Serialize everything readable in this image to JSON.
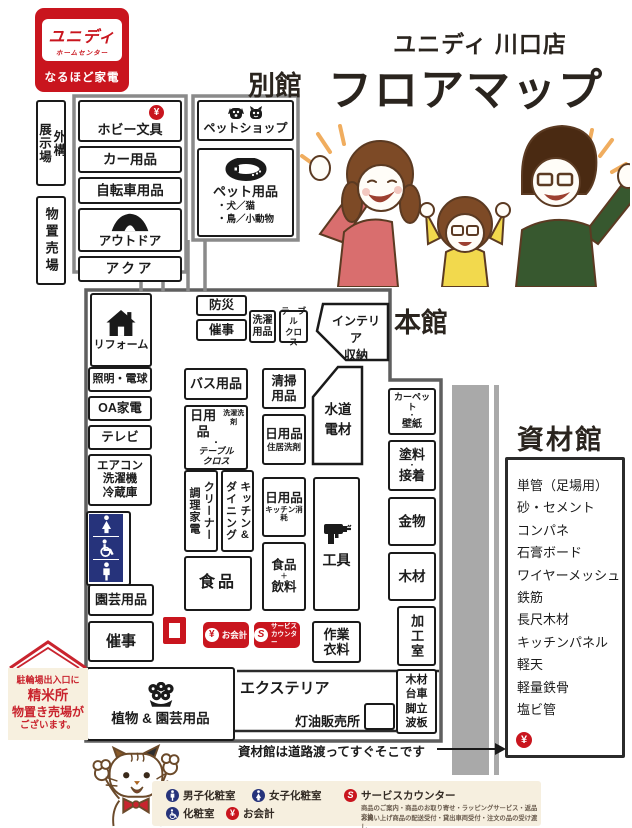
{
  "logo": {
    "brand": "ユニディ",
    "brand_sub": "ホームセンター",
    "tagline": "なるほど家電"
  },
  "title": {
    "store": "ユニディ 川口店",
    "heading": "フロアマップ"
  },
  "sections": {
    "annex": "別館",
    "main": "本館",
    "materials": "資材館"
  },
  "annex": {
    "outdoor_display": "外構\n展示場",
    "storage": "物置売場",
    "hobby": "ホビー文具",
    "car": "カー用品",
    "bicycle": "自転車用品",
    "outdoor": "アウトドア",
    "aqua": "アクア",
    "pet_shop": "ペットショップ",
    "pet_goods": "ペット用品",
    "pet_note": "・犬／猫\n・鳥／小動物"
  },
  "main": {
    "bousai": "防災",
    "event_upper": "催事",
    "laundry": "洗濯\n用品",
    "tablecloth": "テーブル\nクロス",
    "interior_storage": "インテリア\n収納",
    "reform": "リフォーム",
    "lighting": "照明・電球",
    "oa": "OA家電",
    "tv": "テレビ",
    "aircon": "エアコン\n洗濯機\n冷蔵庫",
    "garden": "園芸用品",
    "event_lower": "催事",
    "bath": "バス用品",
    "daily_laundry": {
      "main": "日用品",
      "sub": "洗濯洗剤",
      "dot": "・",
      "sub2": "テーブル\nクロス"
    },
    "cleaning": "清掃\n用品",
    "daily_house": {
      "main": "日用品",
      "sub": "住居洗剤"
    },
    "water": "水道\n電材",
    "cleaner": "クリーナー\n調理家電",
    "kitchen_dining": "キッチン&\nダイニング",
    "food": "食品",
    "daily_kitchen": {
      "main": "日用品",
      "sub": "キッチン消耗"
    },
    "food_drink": {
      "a": "食品",
      "plus": "＋",
      "b": "飲料"
    },
    "tools": "工具",
    "carpet": {
      "a": "カーペット",
      "dot": "・",
      "b": "壁紙"
    },
    "paint": {
      "a": "塗料",
      "dot": "・",
      "b": "接着"
    },
    "hardware": "金物",
    "wood": "木材",
    "workshop": "加工室",
    "workwear": "作業\n衣料",
    "exterior": "エクステリア",
    "kerosene": "灯油販売所",
    "lumber_cart": "木材\n台車\n脚立\n波板",
    "plants": "植物 & 園芸用品"
  },
  "badges": {
    "checkout": "お会計",
    "service": "サービス\nカウンター",
    "yen": "¥",
    "s": "S"
  },
  "materials": {
    "items": [
      "単管（足場用）",
      "砂・セメント",
      "コンパネ",
      "石膏ボード",
      "ワイヤーメッシュ",
      "鉄筋",
      "長尺木材",
      "キッチンパネル",
      "軽天",
      "軽量鉄骨",
      "塩ビ管"
    ]
  },
  "notes": {
    "materials_access": "資材館は道路渡ってすぐそこです",
    "banner_line1": "駐輪場出入口に",
    "banner_line2": "精米所",
    "banner_line3": "物置き売場が",
    "banner_line4": "ございます。"
  },
  "legend": {
    "mens": "男子化粧室",
    "womens": "女子化粧室",
    "accessible": "化粧室",
    "checkout": "お会計",
    "service": "サービスカウンター",
    "service_desc1": "商品のご案内・商品のお取り寄せ・ラッピングサービス・返品交換",
    "service_desc2": "お買い上げ商品の配送受付・貸出車両受付・注文の品の受け渡し"
  },
  "colors": {
    "red": "#c9151e",
    "navy": "#26337b",
    "road": "#a9a9a9"
  }
}
